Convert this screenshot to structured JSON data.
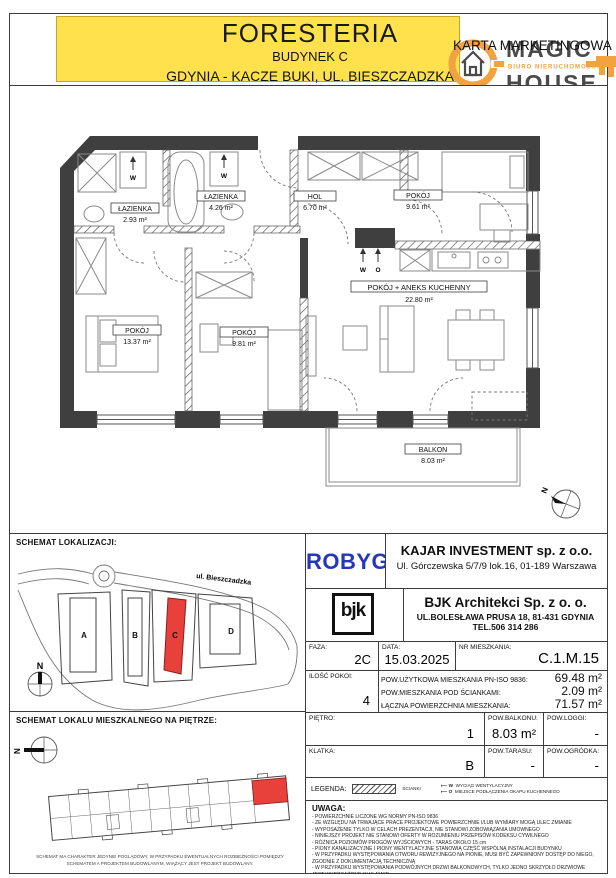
{
  "header": {
    "project": "FORESTERIA",
    "building": "BUDYNEK C",
    "location": "GDYNIA - KACZE BUKI, UL. BIESZCZADZKA",
    "card_type": "KARTA MARKETINGOWA",
    "highlight_color": "#ffe14d"
  },
  "logo": {
    "word_top": "MAGIC",
    "word_bottom": "HOUSE",
    "tagline": "BIURO NIERUCHOMOŚCI",
    "orange": "#f2a23f",
    "gray": "#4a4a4a"
  },
  "plan": {
    "north_label": "N",
    "wall_color": "#3f3f3f",
    "rooms": [
      {
        "name": "ŁAZIENKA",
        "area": "2.93 m²"
      },
      {
        "name": "ŁAZIENKA",
        "area": "4.26 m²"
      },
      {
        "name": "HOL",
        "area": "6.70 m²"
      },
      {
        "name": "POKÓJ",
        "area": "9.61 m²"
      },
      {
        "name": "POKÓJ + ANEKS KUCHENNY",
        "area": "22.80 m²"
      },
      {
        "name": "POKÓJ",
        "area": "13.37 m²"
      },
      {
        "name": "POKÓJ",
        "area": "9.81 m²"
      },
      {
        "name": "BALKON",
        "area": "8.03 m²"
      }
    ],
    "symbols": {
      "vent": "W",
      "hood": "O"
    }
  },
  "location_map": {
    "title": "SCHEMAT LOKALIZACJI:",
    "street": "ul. Bieszczadzka",
    "buildings": [
      "A",
      "B",
      "C",
      "D"
    ],
    "highlighted_building": "C",
    "highlight_color": "#e8403a",
    "north_label": "N"
  },
  "floor_schematic": {
    "title": "SCHEMAT LOKALU MIESZKALNEGO NA PIĘTRZE:",
    "north_label": "N",
    "caption_line1": "SCHEMAT MA CHARAKTER JEDYNIE POGLĄDOWY, W PRZYPADKU EWENTUALNYCH ROZBIEŻNOŚCI POMIĘDZY",
    "caption_line2": "SCHEMATEM A PROJEKTEM BUDOWLANYM, WIĄŻĄCY JEST PROJEKT BUDOWLANY."
  },
  "developer": {
    "logo_text": "ROBYG",
    "logo_color": "#2438b8",
    "company": "KAJAR INVESTMENT sp. z o.o.",
    "address": "Ul. Górczewska 5/7/9 lok.16, 01-189 Warszawa"
  },
  "architect": {
    "logo_text": "bjk",
    "company": "BJK Architekci Sp. z o. o.",
    "address": "UL.BOLESŁAWA PRUSA 18, 81-431 GDYNIA",
    "phone": "TEL.506 314 286"
  },
  "details": {
    "faza_label": "FAZA:",
    "faza_value": "2C",
    "data_label": "DATA:",
    "data_value": "15.03.2025",
    "nr_label": "NR MIESZKANIA:",
    "nr_value": "C.1.M.15",
    "pokoje_label": "ILOŚĆ POKOI:",
    "pokoje_value": "4",
    "areas": [
      {
        "label": "POW.UŻYTKOWA MIESZKANIA PN-ISO 9836:",
        "value": "69.48 m²"
      },
      {
        "label": "POW.MIESZKANIA POD ŚCIANKAMI:",
        "value": "2.09 m²"
      },
      {
        "label": "ŁĄCZNA POWIERZCHNIA MIESZKANIA:",
        "value": "71.57 m²"
      }
    ],
    "pietro_label": "PIĘTRO:",
    "pietro_value": "1",
    "balkon_label": "POW.BALKONU:",
    "balkon_value": "8.03 m²",
    "loggia_label": "POW.LOGGI:",
    "loggia_value": "-",
    "klatka_label": "KLATKA:",
    "klatka_value": "B",
    "taras_label": "POW.TARASU:",
    "taras_value": "-",
    "ogrodek_label": "POW.OGRÓDKA:",
    "ogrodek_value": "-"
  },
  "legend": {
    "label": "LEGENDA:",
    "walls_label": "ŚCIANKI",
    "vent_symbol": "W",
    "vent_label": "WYCIĄG WENTYLACYJNY",
    "hood_symbol": "O",
    "hood_label": "MIEJSCE PODŁĄCZENIA OKAPU KUCHENNEGO"
  },
  "uwaga": {
    "label": "UWAGA:",
    "lines": [
      "- POWIERZCHNIE LICZONE WG NORMY PN-ISO 9836",
      "- ZE WZGLĘDU NA TRWAJĄCE PRACE PROJEKTOWE POWIERZCHNIE I/LUB WYMIARY MOGĄ ULEC ZMIANIE",
      "- WYPOSAŻENIE TYLKO W CELACH PREZENTACJI, NIE STANOWI ZOBOWIĄZANIA UMOWNEGO",
      "- NINIEJSZY PROJEKT NIE STANOWI OFERTY W ROZUMIENIU PRZEPISÓW KODEKSU CYWILNEGO",
      "- RÓŻNICA POZIOMÓW PROGÓW WYJŚCIOWYCH - TARAS OKOŁO 15 cm",
      "- PIONY KANALIZACYJNE I PIONY WENTYLACYJNE STANOWIĄ CZĘŚĆ WSPÓLNĄ INSTALACJI BUDYNKU",
      "- W PRZYPADKU WYSTĘPOWANIA OTWORU REWIZYJNEGO NA PIONIE, MUSI BYĆ ZAPEWNIONY DOSTĘP DO NIEGO,",
      "ZGODNIE Z DOKUMENTACJĄ TECHNICZNĄ",
      "- W PRZYPADKU WYSTĘPOWANIA PODWÓJNYCH DRZWI BALKONOWYCH, TYLKO JEDNO SKRZYDŁO DRZWIOWE",
      "JEST WYPOSAŻONE W KLAMKĘ"
    ]
  }
}
